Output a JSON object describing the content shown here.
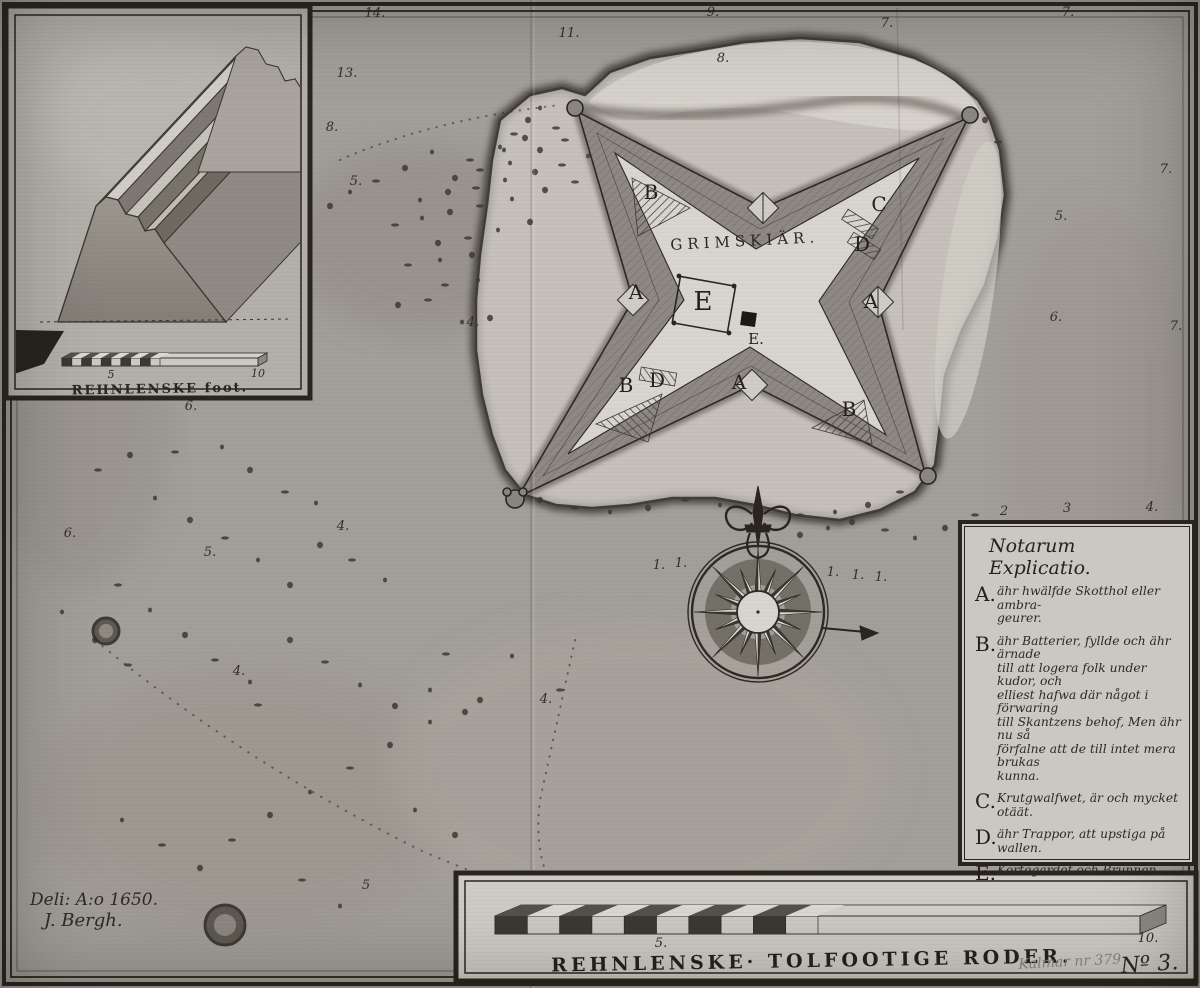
{
  "palette": {
    "ink": "#2e2a23",
    "water": "#a29e98",
    "island": "#c6c2bb",
    "lagoon": "#d7d4cd",
    "courtyard": "#d8d5ce",
    "rampart": "#8e8a83",
    "shore": "#45413a",
    "panel": "#cfccc5",
    "inset_paper": "#b3b0a9",
    "pencil": "#8b877f",
    "dark_seg": "#3c3833",
    "light_seg": "#d8d5ce"
  },
  "map": {
    "fort_label": "GRIMSKIÄR.",
    "fort_markers": [
      {
        "t": "B",
        "x": 651,
        "y": 199
      },
      {
        "t": "C",
        "x": 879,
        "y": 211
      },
      {
        "t": "D",
        "x": 862,
        "y": 251
      },
      {
        "t": "A",
        "x": 636,
        "y": 299
      },
      {
        "t": "A",
        "x": 871,
        "y": 308
      },
      {
        "t": "E",
        "x": 703,
        "y": 310,
        "s": 26
      },
      {
        "t": "E.",
        "x": 756,
        "y": 344,
        "s": 15
      },
      {
        "t": "B",
        "x": 626,
        "y": 392
      },
      {
        "t": "D",
        "x": 657,
        "y": 387
      },
      {
        "t": "A",
        "x": 739,
        "y": 389
      },
      {
        "t": "B",
        "x": 849,
        "y": 416
      }
    ],
    "soundings": [
      {
        "v": "14.",
        "x": 375,
        "y": 17
      },
      {
        "v": "11.",
        "x": 569,
        "y": 37
      },
      {
        "v": "9.",
        "x": 713,
        "y": 16
      },
      {
        "v": "7.",
        "x": 887,
        "y": 27
      },
      {
        "v": "7.",
        "x": 1068,
        "y": 16
      },
      {
        "v": "13.",
        "x": 347,
        "y": 77
      },
      {
        "v": "8.",
        "x": 332,
        "y": 131
      },
      {
        "v": "8.",
        "x": 723,
        "y": 62
      },
      {
        "v": "5.",
        "x": 356,
        "y": 185
      },
      {
        "v": "4.",
        "x": 473,
        "y": 326
      },
      {
        "v": "7.",
        "x": 1166,
        "y": 173
      },
      {
        "v": "5.",
        "x": 1061,
        "y": 220
      },
      {
        "v": "6.",
        "x": 1056,
        "y": 321
      },
      {
        "v": "7.",
        "x": 1176,
        "y": 330
      },
      {
        "v": "6.",
        "x": 191,
        "y": 410
      },
      {
        "v": "6.",
        "x": 70,
        "y": 537
      },
      {
        "v": "4.",
        "x": 343,
        "y": 530
      },
      {
        "v": "5.",
        "x": 210,
        "y": 556
      },
      {
        "v": "2",
        "x": 1004,
        "y": 515
      },
      {
        "v": "3",
        "x": 1067,
        "y": 512
      },
      {
        "v": "4.",
        "x": 1152,
        "y": 511
      },
      {
        "v": "4.",
        "x": 546,
        "y": 703
      },
      {
        "v": "4.",
        "x": 239,
        "y": 675
      },
      {
        "v": "5",
        "x": 366,
        "y": 889
      },
      {
        "v": "1.",
        "x": 659,
        "y": 569
      },
      {
        "v": "1.",
        "x": 681,
        "y": 567
      },
      {
        "v": "1.",
        "x": 833,
        "y": 576
      },
      {
        "v": "1.",
        "x": 858,
        "y": 579
      },
      {
        "v": "1.",
        "x": 881,
        "y": 581
      }
    ],
    "islets": [
      [
        106,
        631,
        13
      ],
      [
        225,
        925,
        20
      ]
    ],
    "stones": [
      [
        432,
        152
      ],
      [
        405,
        168
      ],
      [
        376,
        181
      ],
      [
        350,
        192
      ],
      [
        330,
        206
      ],
      [
        470,
        160
      ],
      [
        500,
        147
      ],
      [
        525,
        138
      ],
      [
        556,
        128
      ],
      [
        585,
        118
      ],
      [
        455,
        178
      ],
      [
        480,
        170
      ],
      [
        510,
        163
      ],
      [
        540,
        150
      ],
      [
        565,
        140
      ],
      [
        420,
        200
      ],
      [
        448,
        192
      ],
      [
        476,
        188
      ],
      [
        505,
        180
      ],
      [
        535,
        172
      ],
      [
        562,
        165
      ],
      [
        588,
        156
      ],
      [
        612,
        148
      ],
      [
        395,
        225
      ],
      [
        422,
        218
      ],
      [
        450,
        212
      ],
      [
        480,
        206
      ],
      [
        512,
        199
      ],
      [
        545,
        190
      ],
      [
        575,
        182
      ],
      [
        602,
        174
      ],
      [
        438,
        243
      ],
      [
        468,
        238
      ],
      [
        498,
        230
      ],
      [
        530,
        222
      ],
      [
        408,
        265
      ],
      [
        440,
        260
      ],
      [
        472,
        255
      ],
      [
        445,
        285
      ],
      [
        478,
        280
      ],
      [
        398,
        305
      ],
      [
        428,
        300
      ],
      [
        462,
        322
      ],
      [
        490,
        318
      ],
      [
        175,
        452
      ],
      [
        222,
        447
      ],
      [
        250,
        470
      ],
      [
        285,
        492
      ],
      [
        316,
        503
      ],
      [
        130,
        455
      ],
      [
        98,
        470
      ],
      [
        155,
        498
      ],
      [
        190,
        520
      ],
      [
        225,
        538
      ],
      [
        258,
        560
      ],
      [
        290,
        585
      ],
      [
        118,
        585
      ],
      [
        150,
        610
      ],
      [
        185,
        635
      ],
      [
        215,
        660
      ],
      [
        250,
        682
      ],
      [
        95,
        640
      ],
      [
        128,
        665
      ],
      [
        62,
        612
      ],
      [
        320,
        545
      ],
      [
        352,
        560
      ],
      [
        385,
        580
      ],
      [
        290,
        640
      ],
      [
        325,
        662
      ],
      [
        360,
        685
      ],
      [
        395,
        706
      ],
      [
        258,
        705
      ],
      [
        430,
        690
      ],
      [
        465,
        712
      ],
      [
        446,
        654
      ],
      [
        512,
        656
      ],
      [
        480,
        700
      ],
      [
        560,
        690
      ],
      [
        430,
        722
      ],
      [
        390,
        745
      ],
      [
        350,
        768
      ],
      [
        310,
        792
      ],
      [
        270,
        815
      ],
      [
        232,
        840
      ],
      [
        415,
        810
      ],
      [
        455,
        835
      ],
      [
        302,
        880
      ],
      [
        340,
        906
      ],
      [
        200,
        868
      ],
      [
        162,
        845
      ],
      [
        122,
        820
      ],
      [
        540,
        500
      ],
      [
        575,
        508
      ],
      [
        610,
        512
      ],
      [
        648,
        508
      ],
      [
        685,
        500
      ],
      [
        720,
        505
      ],
      [
        760,
        512
      ],
      [
        800,
        515
      ],
      [
        835,
        512
      ],
      [
        868,
        505
      ],
      [
        900,
        492
      ],
      [
        930,
        478
      ],
      [
        852,
        522
      ],
      [
        885,
        530
      ],
      [
        915,
        538
      ],
      [
        945,
        528
      ],
      [
        975,
        515
      ],
      [
        540,
        108
      ],
      [
        528,
        120
      ],
      [
        514,
        134
      ],
      [
        504,
        150
      ],
      [
        985,
        120
      ],
      [
        998,
        142
      ],
      [
        828,
        528
      ],
      [
        800,
        535
      ]
    ]
  },
  "inset": {
    "scale_mid_label": "5",
    "scale_end_label": "10",
    "caption": "REHNLENSKE foot."
  },
  "legend": {
    "title": "Notarum Explicatio.",
    "entries": [
      {
        "letter": "A.",
        "lines": [
          "ähr hwälfde Skotthol eller ambra-",
          "geurer."
        ]
      },
      {
        "letter": "B.",
        "lines": [
          "ähr Batterier, fyllde och ähr ärnade",
          "till att logera folk under kudor, och",
          "elliest hafwa där något i förwaring",
          "till Skantzens behof, Men ähr nu så",
          "förfalne att de till intet mera brukas",
          "kunna."
        ]
      },
      {
        "letter": "C.",
        "lines": [
          "Krutgwalfwet, är och mycket otäät."
        ]
      },
      {
        "letter": "D.",
        "lines": [
          "ähr Trappor, att upstiga på",
          "wallen."
        ]
      },
      {
        "letter": "E.",
        "lines": [
          "Kortegardet och Brunnen."
        ]
      }
    ]
  },
  "scalebar": {
    "mid_label": "5.",
    "end_label": "10.",
    "caption": "REHNLENSKE· TOLFOOTIGE RODER.",
    "pencil_note": "Kalmar nr 379",
    "sheet_number": "Nº 3."
  },
  "signature": {
    "line1": "Deli: A:o 1650.",
    "line2": "J. Bergh."
  }
}
